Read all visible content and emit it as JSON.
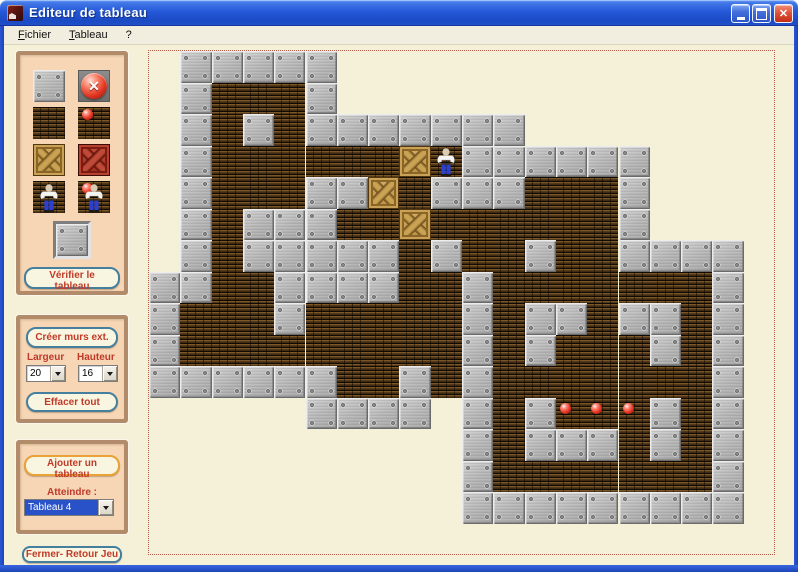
{
  "window": {
    "title": "Editeur de tableau",
    "controls": {
      "minimize": "minimize",
      "maximize": "maximize",
      "close": "close"
    }
  },
  "menu": {
    "items": [
      {
        "label": "Fichier",
        "underline_first": true
      },
      {
        "label": "Tableau",
        "underline_first": true
      },
      {
        "label": "?",
        "underline_first": false
      }
    ]
  },
  "palette": {
    "tiles": [
      {
        "kind": "wall",
        "name": "wall-tile"
      },
      {
        "kind": "eraser",
        "name": "eraser-tool"
      },
      {
        "kind": "floor",
        "name": "floor-tile"
      },
      {
        "kind": "target",
        "name": "target-tile"
      },
      {
        "kind": "crate",
        "name": "crate-tile"
      },
      {
        "kind": "crate-red",
        "name": "crate-on-target-tile"
      },
      {
        "kind": "player",
        "name": "player-tile"
      },
      {
        "kind": "player-target",
        "name": "player-on-target-tile"
      }
    ],
    "preview_kind": "wall",
    "verify_button_label": "Vérifier le tableau"
  },
  "tools": {
    "create_walls_button": "Créer murs ext.",
    "width_label": "Largeur",
    "width_value": "20",
    "height_label": "Hauteur",
    "height_value": "16",
    "clear_button": "Effacer tout"
  },
  "boards": {
    "add_button": "Ajouter un tableau",
    "goto_label": "Atteindre :",
    "goto_value": "Tableau 4"
  },
  "footer": {
    "close_button_label": "Fermer- Retour Jeu"
  },
  "level": {
    "cols": 20,
    "rows": 16,
    "tile_w": 31.3,
    "tile_h": 31.5,
    "legend": {
      ".": "empty",
      "W": "wall",
      "F": "floor",
      "C": "crate",
      "P": "player",
      "B": "target-ball"
    },
    "map": [
      ".WWWWW..............",
      ".WFFFW..............",
      ".WFWFWWWWWWW........",
      ".WFFFFFFCPWWWWWW....",
      ".WFFFWWCFWWWFFFW....",
      ".WFWWWFFCFFFFFFW....",
      ".WFWWWWWFWFFWFFWWWW.",
      "WWFFWWWWFFWFFFFFFFW.",
      "WFFFWFFFFFWFWWFWWFW.",
      "WFFFFFFFFFWFWFFFWFW.",
      "WWWWWWFFWFWFFFFFFFW.",
      ".....WWWW.WFWBBBWFW.",
      "..........WFWWWFWFW.",
      "..........WFFFFFFFW.",
      "..........WWWWWWWWW.",
      "...................."
    ]
  },
  "colors": {
    "titlebar_blue": "#2458d8",
    "close_red": "#e05438",
    "content_cream": "#f4f1d8",
    "panel_peach": "#f6d6b5",
    "panel_border": "#b28b6b",
    "button_text_red": "#c23a28",
    "button_border_teal": "#44809e",
    "button_border_orange": "#e8a238",
    "dashed_border": "#b85a48",
    "selection_blue": "#2a52c8",
    "wall_gray": "#b6b6b6",
    "floor_brown": "#543918",
    "crate_tan": "#c9a258",
    "crate_red": "#b84030",
    "ball_red": "#ea3826"
  }
}
